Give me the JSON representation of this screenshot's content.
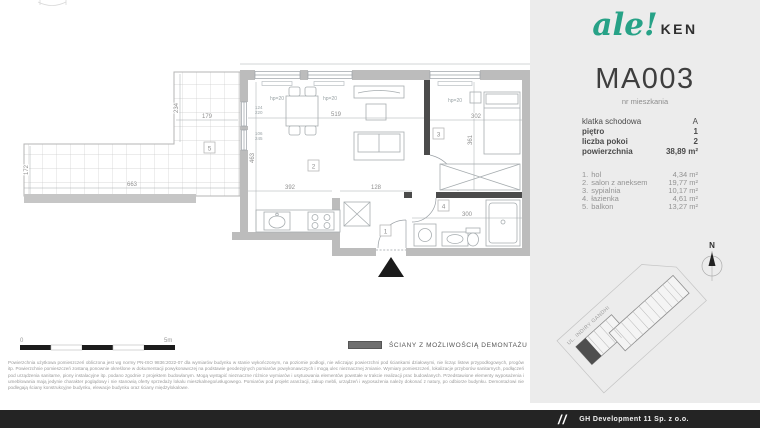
{
  "brand": {
    "script": "ale!",
    "suffix": "KEN"
  },
  "unit": {
    "code": "MA003",
    "caption": "nr mieszkania"
  },
  "details": [
    {
      "label": "klatka schodowa",
      "value": "A"
    },
    {
      "label": "piętro",
      "value": "1"
    },
    {
      "label": "liczba pokoi",
      "value": "2"
    },
    {
      "label": "powierzchnia",
      "value": "38,89 m²"
    }
  ],
  "rooms": [
    {
      "no": "1.",
      "name": "hol",
      "area": "4,34 m²"
    },
    {
      "no": "2.",
      "name": "salon z aneksem",
      "area": "19,77 m²"
    },
    {
      "no": "3.",
      "name": "sypialnia",
      "area": "10,17 m²"
    },
    {
      "no": "4.",
      "name": "łazienka",
      "area": "4,61 m²"
    },
    {
      "no": "5.",
      "name": "balkon",
      "area": "13,27 m²"
    }
  ],
  "plan": {
    "numbers": {
      "hol": "1",
      "salon": "2",
      "bedroom": "3",
      "bathroom": "4",
      "balcony": "5"
    },
    "dims": {
      "balcony_width": "663",
      "balcony_depth": "172",
      "arm_height": "234",
      "arm_width": "179",
      "salon_width": "519",
      "salon_height": "463",
      "kitchen_width": "392",
      "hall_width": "128",
      "bedroom_width": "302",
      "bedroom_height": "361",
      "bathroom_width": "300"
    },
    "windows": {
      "hp_salon_1": "hp=20",
      "hp_salon_2": "hp=20",
      "hp_bedroom": "hp=20",
      "door_w": "124",
      "door_h": "220",
      "window_w": "106",
      "window_h": "245"
    }
  },
  "scalebar": {
    "start": "0",
    "end": "5m"
  },
  "legend": {
    "demountable_walls": "ŚCIANY Z MOŻLIWOŚCIĄ DEMONTAŻU"
  },
  "siteplan": {
    "street": "UL. INDIRY GANDHI",
    "north": "N"
  },
  "disclaimer": "Powierzchnia użytkowa pomieszczeń obliczona jest wg normy PN-ISO 9836:2022-07 dla wymiarów budynku w stanie wykończonym, na poziomie podłogi, nie wliczając powierzchni pod ściankami działowymi, nie licząc listew przypodłogowych, progów itp. Powierzchnie pomieszczeń zostaną ponownie określone w dokumentacji powykonawczej na podstawie geodezyjnych pomiarów powykonawczych i mogą ulec nieznacznej zmianie. Wymiary pomieszczeń, lokalizacje przyborów sanitarnych, podłączeń pod urządzenia sanitarne, piony instalacyjne itp. podano zgodnie z projektem budowlanym. Mogą wystąpić nieznaczne różnice wymiarów i usytuowania elementów powstałe w trakcie realizacji prac budowlanych. Przedstawione elementy wyposażenia i umeblowania mają jedynie charakter poglądowy i nie stanowią oferty sprzedaży lokalu mieszkalnego/usługowego. Pomiarów pod projekt aranżacji, zakup mebli, urządzeń i wyposażenia należy dokonać z natury, po odbiorze budynku. Demontażowi nie podlegają ściany konstrukcyjne budynku, elewacje budynku oraz ściany międzylokalowe.",
  "footer": {
    "mark": "//",
    "company": "GH Development 11 Sp. z o.o."
  }
}
